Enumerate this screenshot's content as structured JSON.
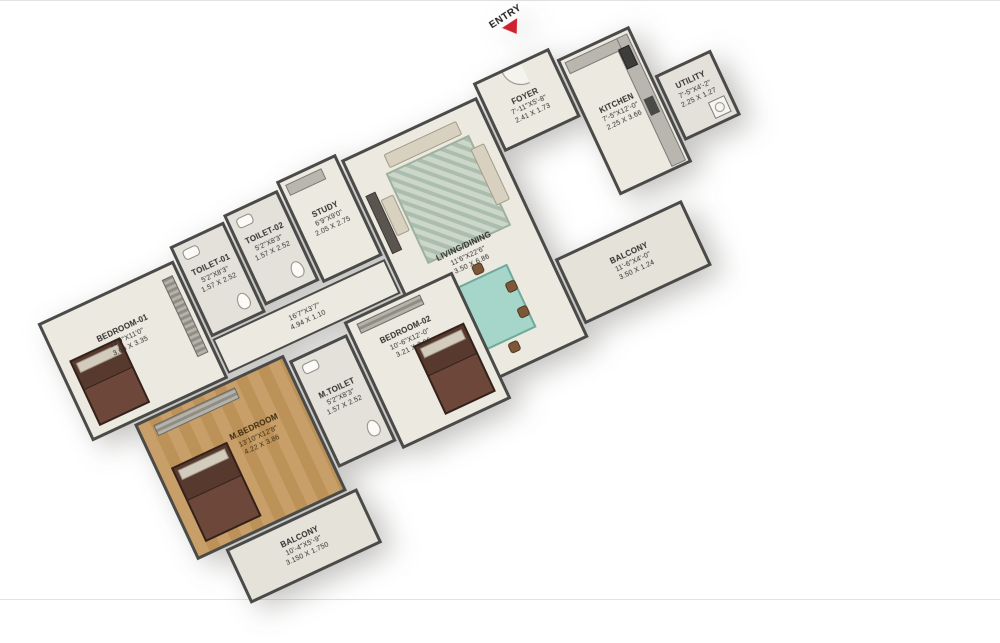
{
  "entry": {
    "label": "ENTRY"
  },
  "rooms": {
    "foyer": {
      "name": "FOYER",
      "feet": "7'-11\"X5'-8\"",
      "meters": "2.41 X 1.73"
    },
    "kitchen": {
      "name": "KITCHEN",
      "feet": "7'-5\"X12'-0\"",
      "meters": "2.25 X 3.66"
    },
    "utility": {
      "name": "UTILITY",
      "feet": "7'-5\"X4'-2\"",
      "meters": "2.25 X 1.27"
    },
    "living_dining": {
      "name": "LIVING/DINING",
      "feet": "11'6\"X22'6\"",
      "meters": "3.50 X 6.86"
    },
    "study": {
      "name": "STUDY",
      "feet": "6'9\"X9'0\"",
      "meters": "2.05 X 2.75"
    },
    "toilet01": {
      "name": "TOILET-01",
      "feet": "5'2\"X8'3\"",
      "meters": "1.57 X 2.52"
    },
    "toilet02": {
      "name": "TOILET-02",
      "feet": "5'2\"X8'3\"",
      "meters": "1.57 X 2.52"
    },
    "bedroom01": {
      "name": "BEDROOM-01",
      "feet": "12'0\"X11'0\"",
      "meters": "3.66 X 3.35"
    },
    "mbedroom": {
      "name": "M.BEDROOM",
      "feet": "13'10\"X12'8\"",
      "meters": "4.22 X 3.86"
    },
    "mtoilet": {
      "name": "M.TOILET",
      "feet": "5'2\"X8'3\"",
      "meters": "1.57 X 2.52"
    },
    "bedroom02": {
      "name": "BEDROOM-02",
      "feet": "10'-6\"X12'-0\"",
      "meters": "3.21 X 3.66"
    },
    "passage": {
      "feet": "16'7\"X3'7\"",
      "meters": "4.94 X 1.10"
    },
    "balcony_bottom": {
      "name": "BALCONY",
      "feet": "10'-4\"X5'-9\"",
      "meters": "3.150 X 1.750"
    },
    "balcony_right": {
      "name": "BALCONY",
      "feet": "11'-6\"X4'-0\"",
      "meters": "3.50 X 1.24"
    }
  },
  "colors": {
    "wall": "#4a4a48",
    "floor": "#ece9e0",
    "wood_floor": "#c89f68",
    "dining_table": "#a6d6c9",
    "entry_arrow": "#ce2231"
  }
}
